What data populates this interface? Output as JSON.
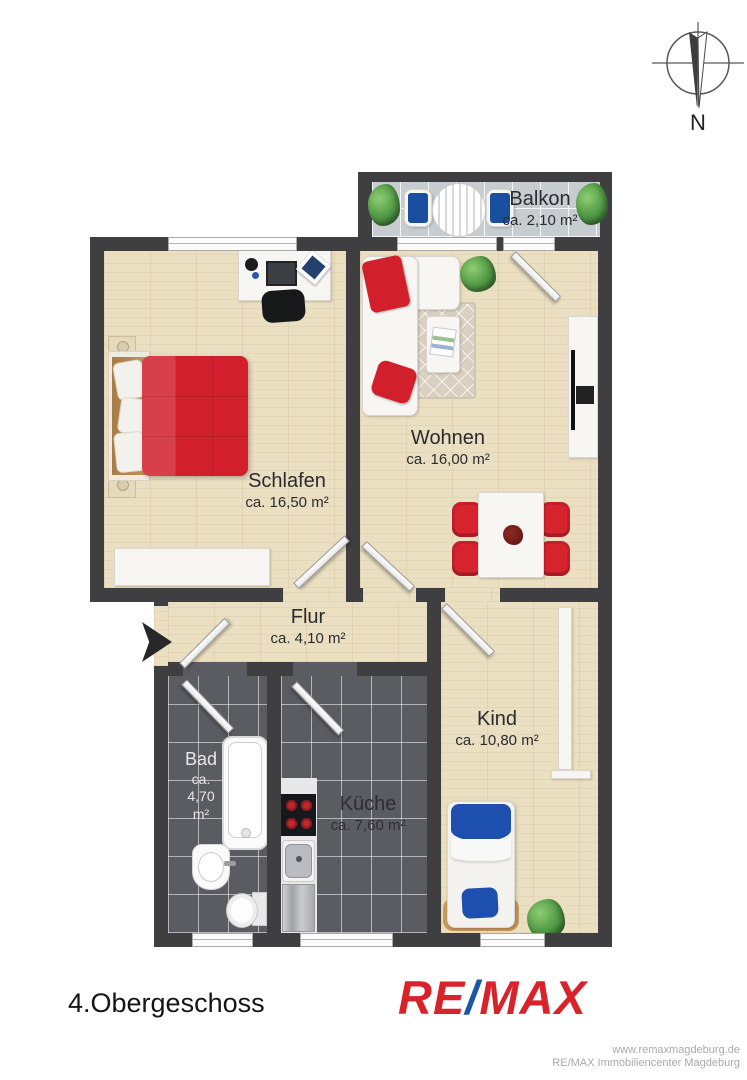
{
  "compass": {
    "label": "N"
  },
  "rooms": {
    "balkon": {
      "name": "Balkon",
      "area": "ca. 2,10 m²"
    },
    "schlafen": {
      "name": "Schlafen",
      "area": "ca. 16,50 m²"
    },
    "wohnen": {
      "name": "Wohnen",
      "area": "ca. 16,00 m²"
    },
    "flur": {
      "name": "Flur",
      "area": "ca. 4,10 m²"
    },
    "bad": {
      "name": "Bad",
      "area_lines": [
        "ca.",
        "4,70",
        "m²"
      ]
    },
    "kueche": {
      "name": "Küche",
      "area": "ca. 7,60 m²"
    },
    "kind": {
      "name": "Kind",
      "area": "ca. 10,80 m²"
    }
  },
  "floor_label": "4.Obergeschoss",
  "logo": {
    "re": "RE",
    "slash": "/",
    "max": "MAX"
  },
  "footer": {
    "website": "www.remaxmagdeburg.de",
    "company": "RE/MAX Immobiliencenter Magdeburg"
  },
  "colors": {
    "wall": "#3f3f42",
    "wood_floor": "#ebdfc2",
    "dark_tile": "#5b5b62",
    "balcony_tile": "#c7ccd1",
    "bed_red": "#d1202c",
    "chair_red": "#d7232e",
    "kid_blue": "#1d4fae",
    "balcony_chair_blue": "#1a4fa0",
    "logo_red": "#d9232a",
    "logo_blue": "#1b57a5"
  }
}
